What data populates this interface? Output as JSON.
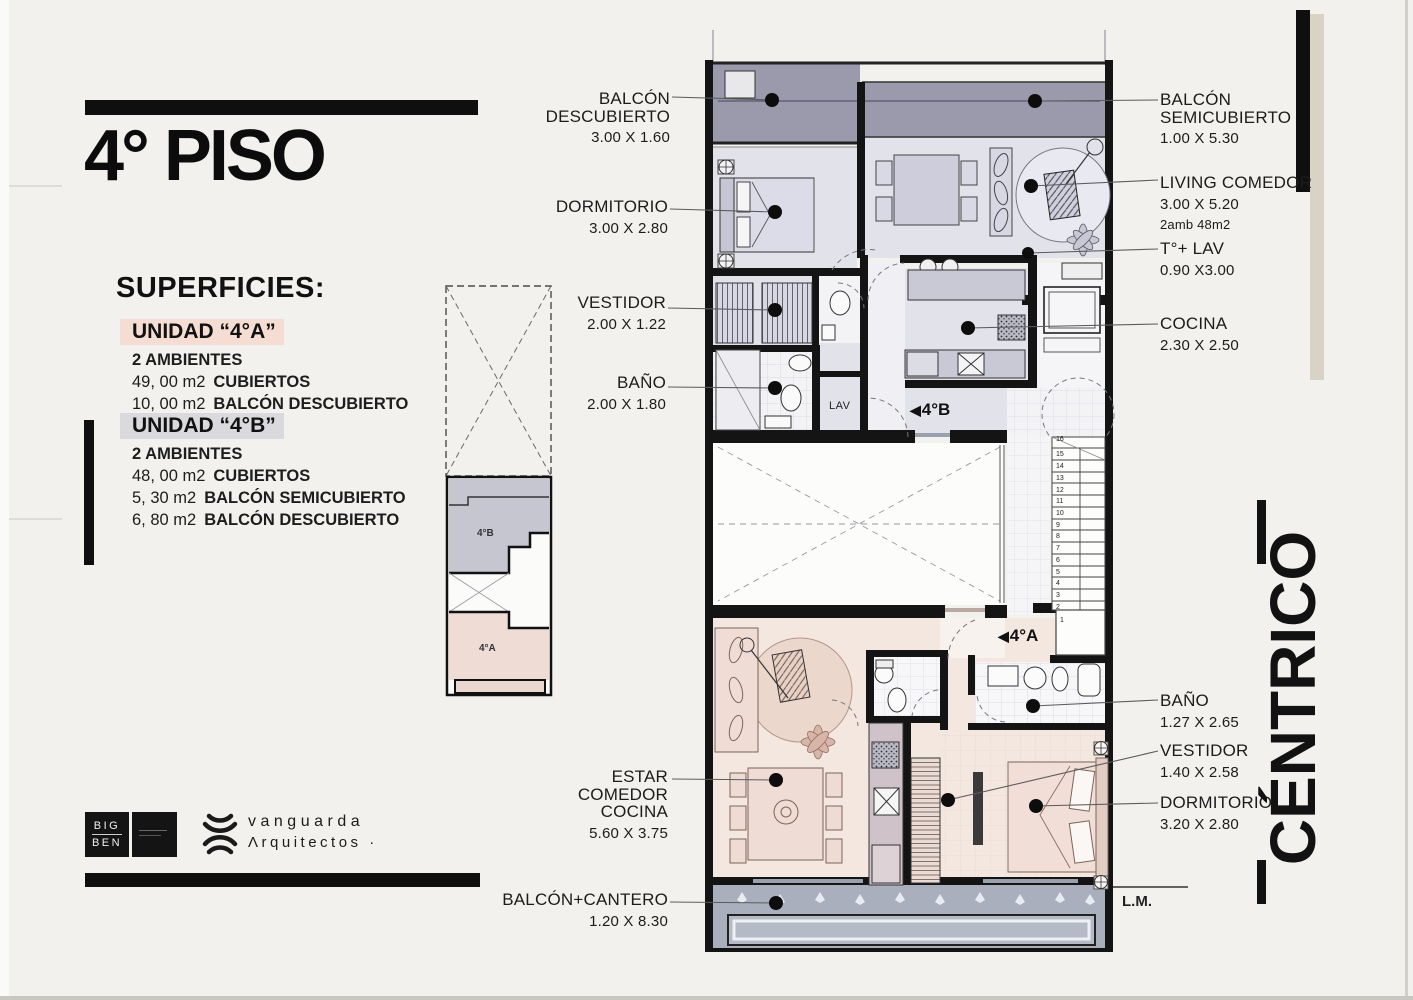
{
  "page": {
    "title": "4° PISO"
  },
  "superficies": {
    "heading": "SUPERFICIES:",
    "units": [
      {
        "name": "UNIDAD “4°A”",
        "ambientes": "2 AMBIENTES",
        "rows": [
          {
            "value": "49, 00 m2",
            "label": "CUBIERTOS"
          },
          {
            "value": "10, 00 m2",
            "label": "BALCÓN DESCUBIERTO"
          }
        ]
      },
      {
        "name": "UNIDAD “4°B”",
        "ambientes": "2 AMBIENTES",
        "rows": [
          {
            "value": "48, 00 m2",
            "label": "CUBIERTOS"
          },
          {
            "value": "5, 30 m2",
            "label": "BALCÓN SEMICUBIERTO"
          },
          {
            "value": "6, 80 m2",
            "label": "BALCÓN DESCUBIERTO"
          }
        ]
      }
    ]
  },
  "rooms": {
    "balcon_descubierto": {
      "line1": "BALCÓN",
      "line2": "DESCUBIERTO",
      "dims": "3.00 X 1.60"
    },
    "dormitorio_b": {
      "name": "DORMITORIO",
      "dims": "3.00 X 2.80"
    },
    "vestidor_b": {
      "name": "VESTIDOR",
      "dims": "2.00 X 1.22"
    },
    "bano_b": {
      "name": "BAÑO",
      "dims": "2.00 X 1.80"
    },
    "balcon_semicubierto": {
      "line1": "BALCÓN",
      "line2": "SEMICUBIERTO",
      "dims": "1.00 X 5.30"
    },
    "living_comedor": {
      "name": "LIVING COMEDOR",
      "dims": "3.00 X 5.20",
      "note": "2amb 48m2"
    },
    "t_lav": {
      "name": "T°+ LAV",
      "dims": "0.90 X3.00"
    },
    "cocina": {
      "name": "COCINA",
      "dims": "2.30 X 2.50"
    },
    "bano_a": {
      "name": "BAÑO",
      "dims": "1.27 X 2.65"
    },
    "vestidor_a": {
      "name": "VESTIDOR",
      "dims": "1.40 X 2.58"
    },
    "dormitorio_a": {
      "name": "DORMITORIO",
      "dims": "3.20 X 2.80"
    },
    "estar": {
      "line1": "ESTAR",
      "line2": "COMEDOR",
      "line3": "COCINA",
      "dims": "5.60 X 3.75"
    },
    "balcon_cantero": {
      "name": "BALCÓN+CANTERO",
      "dims": "1.20 X 8.30"
    }
  },
  "plan": {
    "marker_b": "4°B",
    "marker_a": "4°A",
    "lav": "LAV",
    "lm": "L.M.",
    "stair_numbers": [
      "16",
      "15",
      "14",
      "13",
      "12",
      "11",
      "10",
      "9",
      "8",
      "7",
      "6",
      "5",
      "4",
      "3",
      "2",
      "1"
    ]
  },
  "keyplan": {
    "unit_b": "4°B",
    "unit_a": "4°A"
  },
  "side_text": {
    "value": "CÉNTRICO"
  },
  "brand": {
    "bigben_line1": "BIG",
    "bigben_line2": "BEN",
    "studio_line1": "vanguarda",
    "studio_line2": "Λrquitectos ·"
  },
  "icons": {
    "entry_arrow": "◀"
  },
  "colors": {
    "paper": "#f2f1ed",
    "wall": "#141414",
    "balcony_top": "#9b9aad",
    "floor_unit_b": "#e2e2eb",
    "floor_unit_a": "#f4e7e0",
    "balcony_bottom": "#a9afbc",
    "highlight_a": "#f6ddd3",
    "highlight_b": "#dadade",
    "beige_strip": "#d9d3c6"
  }
}
